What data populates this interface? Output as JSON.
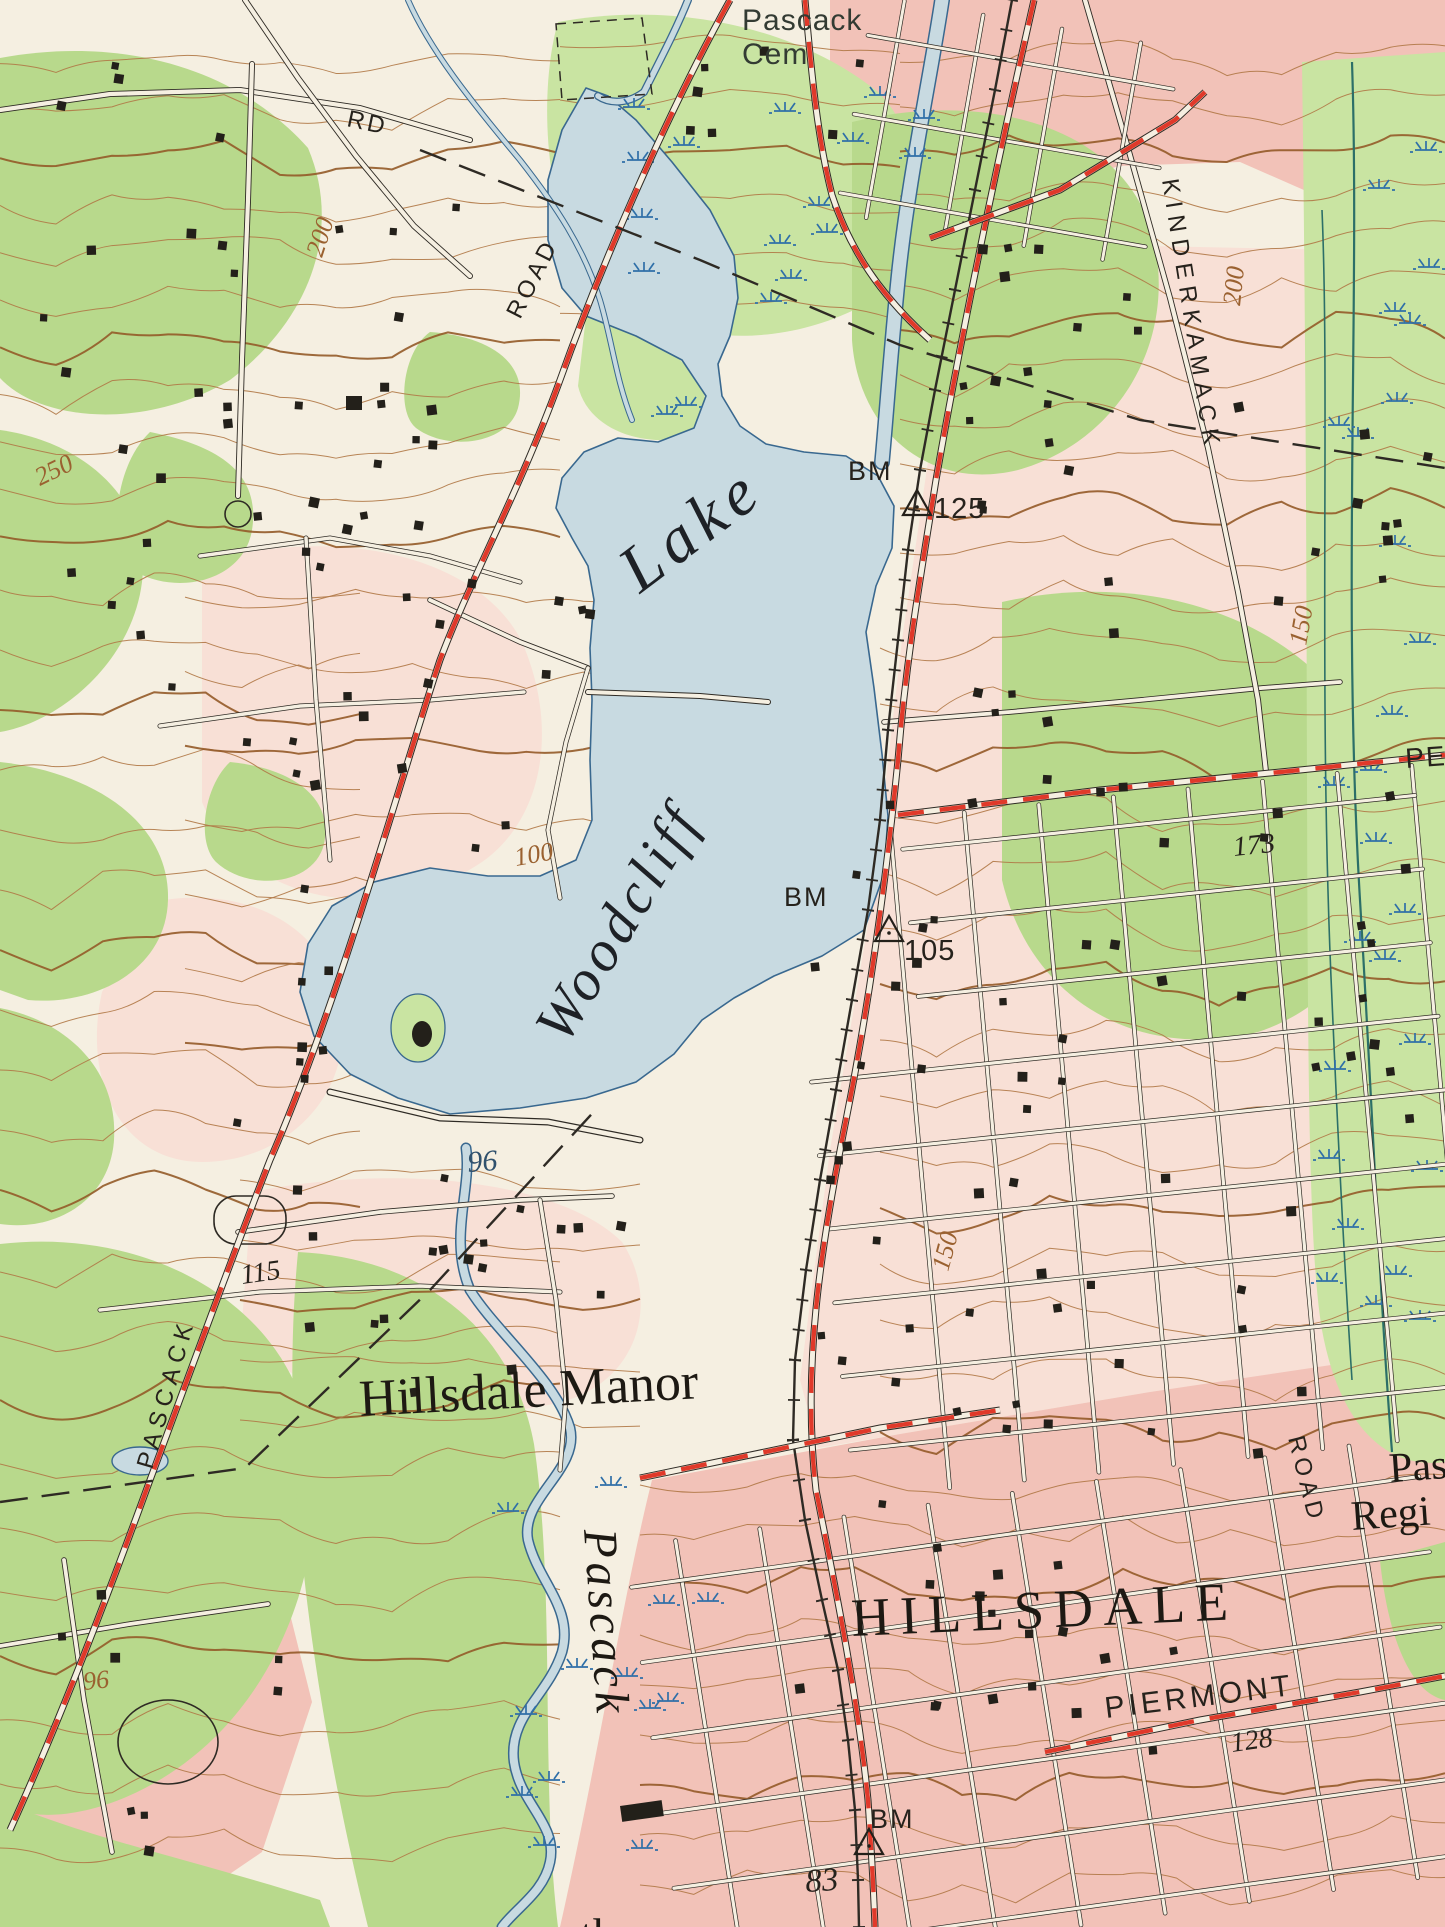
{
  "map": {
    "title": "USGS topographic map - Woodcliff Lake / Hillsdale quadrangle detail",
    "colors": {
      "paper": "#f5efe1",
      "pink_urban": "#f2c2b8",
      "pink_pale": "#f8e0d6",
      "green_wood": "#b8d98c",
      "green_light": "#c9e4a2",
      "water_fill": "#c8dae1",
      "water_edge": "#39688f",
      "contour": "#b07846",
      "contour_index": "#935a28",
      "road_red": "#e0392a",
      "ink_black": "#2e2a24",
      "marsh_blue": "#2f6fa8",
      "stream_teal": "#2c6f68",
      "label_brown": "#9a6130",
      "label_blue": "#30516d",
      "label_dark": "#26221c",
      "cem_green": "#333b33"
    },
    "labels": [
      {
        "id": "pascack-cem-line1",
        "t": "Pascack",
        "x": 742,
        "y": 30,
        "r": 0,
        "fs": 30,
        "c": "#333b33",
        "f": "sans",
        "ls": 1
      },
      {
        "id": "pascack-cem-line2",
        "t": "Cem",
        "x": 742,
        "y": 64,
        "r": 0,
        "fs": 30,
        "c": "#333b33",
        "f": "sans",
        "ls": 1
      },
      {
        "id": "rd-label",
        "t": "RD",
        "x": 346,
        "y": 126,
        "r": 12,
        "fs": 24,
        "c": "#26221c",
        "f": "sans",
        "ls": 3
      },
      {
        "id": "road-label-nw",
        "t": "ROAD",
        "x": 520,
        "y": 320,
        "r": -63,
        "fs": 24,
        "c": "#26221c",
        "f": "sans",
        "ls": 4
      },
      {
        "id": "contour-200-nw",
        "t": "200",
        "x": 322,
        "y": 258,
        "r": -72,
        "fs": 26,
        "c": "#9a6130",
        "f": "serif",
        "i": 1
      },
      {
        "id": "contour-250-w",
        "t": "250",
        "x": 40,
        "y": 486,
        "r": -26,
        "fs": 26,
        "c": "#9a6130",
        "f": "serif",
        "i": 1
      },
      {
        "id": "kinderkamack-label",
        "t": "KINDERKAMACK",
        "x": 1162,
        "y": 180,
        "r": 81,
        "fs": 24,
        "c": "#26221c",
        "f": "sans",
        "ls": 7
      },
      {
        "id": "contour-200-ne",
        "t": "200",
        "x": 1240,
        "y": 306,
        "r": -84,
        "fs": 26,
        "c": "#9a6130",
        "f": "serif",
        "i": 1
      },
      {
        "id": "contour-150-e",
        "t": "150",
        "x": 1306,
        "y": 646,
        "r": -80,
        "fs": 26,
        "c": "#9a6130",
        "f": "serif",
        "i": 1
      },
      {
        "id": "bm-125-bm",
        "t": "BM",
        "x": 848,
        "y": 480,
        "r": 0,
        "fs": 27,
        "c": "#26221c",
        "f": "sans",
        "ls": 2
      },
      {
        "id": "bm-125-num",
        "t": "125",
        "x": 934,
        "y": 518,
        "r": 0,
        "fs": 29,
        "c": "#26221c",
        "f": "sans",
        "ls": 1
      },
      {
        "id": "lake-word",
        "t": "Lake",
        "x": 640,
        "y": 594,
        "r": -37,
        "fs": 66,
        "c": "#1e2126",
        "f": "serif",
        "i": 1,
        "ls": 8
      },
      {
        "id": "woodcliff-word",
        "t": "Woodcliff",
        "x": 566,
        "y": 1046,
        "r": -59,
        "fs": 58,
        "c": "#1e2126",
        "f": "serif",
        "i": 1,
        "ls": 5
      },
      {
        "id": "bm-105-bm",
        "t": "BM",
        "x": 784,
        "y": 906,
        "r": 0,
        "fs": 27,
        "c": "#26221c",
        "f": "sans",
        "ls": 2
      },
      {
        "id": "bm-105-num",
        "t": "105",
        "x": 904,
        "y": 960,
        "r": 0,
        "fs": 29,
        "c": "#26221c",
        "f": "sans",
        "ls": 1
      },
      {
        "id": "spot-173",
        "t": "173",
        "x": 1234,
        "y": 856,
        "r": -6,
        "fs": 28,
        "c": "#26221c",
        "f": "serif",
        "i": 1
      },
      {
        "id": "contour-100-w",
        "t": "100",
        "x": 516,
        "y": 866,
        "r": -10,
        "fs": 26,
        "c": "#9a6130",
        "f": "serif",
        "i": 1
      },
      {
        "id": "lake-elev-96",
        "t": "96",
        "x": 468,
        "y": 1172,
        "r": -4,
        "fs": 30,
        "c": "#30516d",
        "f": "serif",
        "i": 1
      },
      {
        "id": "spot-115",
        "t": "115",
        "x": 242,
        "y": 1284,
        "r": -8,
        "fs": 28,
        "c": "#26221c",
        "f": "serif",
        "i": 1
      },
      {
        "id": "pascack-road-label",
        "t": "PASCACK",
        "x": 152,
        "y": 1470,
        "r": -74,
        "fs": 24,
        "c": "#26221c",
        "f": "sans",
        "ls": 6
      },
      {
        "id": "contour-150-mid",
        "t": "150",
        "x": 948,
        "y": 1272,
        "r": -75,
        "fs": 26,
        "c": "#9a6130",
        "f": "serif",
        "i": 1
      },
      {
        "id": "hillsdale-manor-label",
        "t": "Hillsdale Manor",
        "x": 360,
        "y": 1416,
        "r": -3,
        "fs": 52,
        "c": "#1d1913",
        "f": "serif"
      },
      {
        "id": "pascack-brook-label",
        "t": "Pascack",
        "x": 584,
        "y": 1530,
        "r": 86,
        "fs": 48,
        "c": "#1d1913",
        "f": "serif",
        "i": 1,
        "ls": 4
      },
      {
        "id": "hillsdale-label",
        "t": "HILLSDALE",
        "x": 852,
        "y": 1636,
        "r": -2.5,
        "fs": 54,
        "c": "#1d1913",
        "f": "serif",
        "ls": 10
      },
      {
        "id": "piermont-label",
        "t": "PIERMONT",
        "x": 1106,
        "y": 1718,
        "r": -7,
        "fs": 30,
        "c": "#26221c",
        "f": "sans",
        "ls": 4
      },
      {
        "id": "spot-128",
        "t": "128",
        "x": 1232,
        "y": 1752,
        "r": -8,
        "fs": 28,
        "c": "#26221c",
        "f": "serif",
        "i": 1
      },
      {
        "id": "road-label-e",
        "t": "ROAD",
        "x": 1288,
        "y": 1438,
        "r": 76,
        "fs": 24,
        "c": "#26221c",
        "f": "sans",
        "ls": 5
      },
      {
        "id": "pas-school-1",
        "t": "Pas",
        "x": 1390,
        "y": 1482,
        "r": -4,
        "fs": 42,
        "c": "#1d1913",
        "f": "serif"
      },
      {
        "id": "pas-school-2",
        "t": "Regi",
        "x": 1352,
        "y": 1530,
        "r": -4,
        "fs": 42,
        "c": "#1d1913",
        "f": "serif"
      },
      {
        "id": "bm-83-bm",
        "t": "BM",
        "x": 870,
        "y": 1828,
        "r": 0,
        "fs": 27,
        "c": "#26221c",
        "f": "sans",
        "ls": 2
      },
      {
        "id": "spot-83",
        "t": "83",
        "x": 806,
        "y": 1892,
        "r": -4,
        "fs": 33,
        "c": "#26221c",
        "f": "serif",
        "i": 1
      },
      {
        "id": "pe-edge-label",
        "t": "PE",
        "x": 1406,
        "y": 768,
        "r": -4,
        "fs": 28,
        "c": "#26221c",
        "f": "sans",
        "ls": 2
      },
      {
        "id": "contour-96-sw",
        "t": "96",
        "x": 84,
        "y": 1690,
        "r": -6,
        "fs": 26,
        "c": "#9a6130",
        "f": "serif",
        "i": 1
      },
      {
        "id": "bottom-edge-fragment",
        "t": "th",
        "x": 580,
        "y": 1950,
        "r": 0,
        "fs": 46,
        "c": "#1d1913",
        "f": "serif"
      }
    ],
    "benchmarks": [
      {
        "id": "bm-triangle-125",
        "x": 917,
        "y": 505
      },
      {
        "id": "bm-triangle-105",
        "x": 889,
        "y": 931
      },
      {
        "id": "bm-triangle-83",
        "x": 869,
        "y": 1844
      }
    ]
  }
}
